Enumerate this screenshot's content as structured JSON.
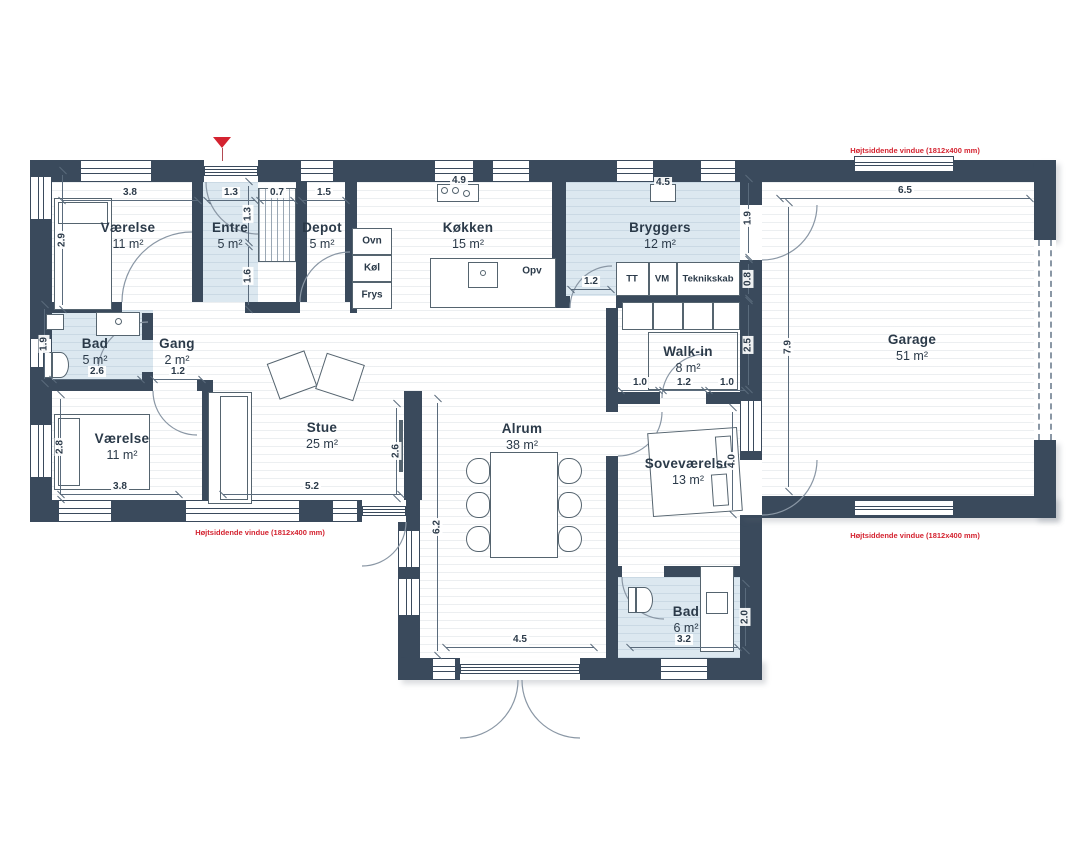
{
  "palette": {
    "wall": "#3a4a5c",
    "blue_room": "#dce8f0",
    "annotation_red": "#d42330",
    "line": "#5a6b7c"
  },
  "annotations": {
    "high_window_note": "Højtsiddende vindue (1812x400 mm)"
  },
  "rooms": [
    {
      "name": "Værelse",
      "area": "11 m²"
    },
    {
      "name": "Entre",
      "area": "5 m²"
    },
    {
      "name": "Depot",
      "area": "5 m²"
    },
    {
      "name": "Køkken",
      "area": "15 m²"
    },
    {
      "name": "Bryggers",
      "area": "12 m²"
    },
    {
      "name": "Garage",
      "area": "51 m²"
    },
    {
      "name": "Bad",
      "area": "5 m²"
    },
    {
      "name": "Gang",
      "area": "2 m²"
    },
    {
      "name": "Værelse",
      "area": "11 m²"
    },
    {
      "name": "Stue",
      "area": "25 m²"
    },
    {
      "name": "Alrum",
      "area": "38 m²"
    },
    {
      "name": "Walk-in",
      "area": "8 m²"
    },
    {
      "name": "Soveværelse",
      "area": "13 m²"
    },
    {
      "name": "Bad",
      "area": "6 m²"
    }
  ],
  "fixtures": {
    "ovn": "Ovn",
    "koel": "Køl",
    "frys": "Frys",
    "opv": "Opv",
    "tt": "TT",
    "vm": "VM",
    "teknikskab": "Teknikskab"
  },
  "dimensions": [
    "3.8",
    "1.3",
    "0.7",
    "1.5",
    "2.9",
    "1.3",
    "1.6",
    "4.9",
    "4.5",
    "1.9",
    "0.8",
    "1.2",
    "2.5",
    "1.0",
    "1.2",
    "1.0",
    "6.5",
    "7.9",
    "2.6",
    "1.2",
    "1.9",
    "2.8",
    "3.8",
    "5.2",
    "2.6",
    "6.2",
    "4.5",
    "4.0",
    "3.2",
    "2.0"
  ]
}
